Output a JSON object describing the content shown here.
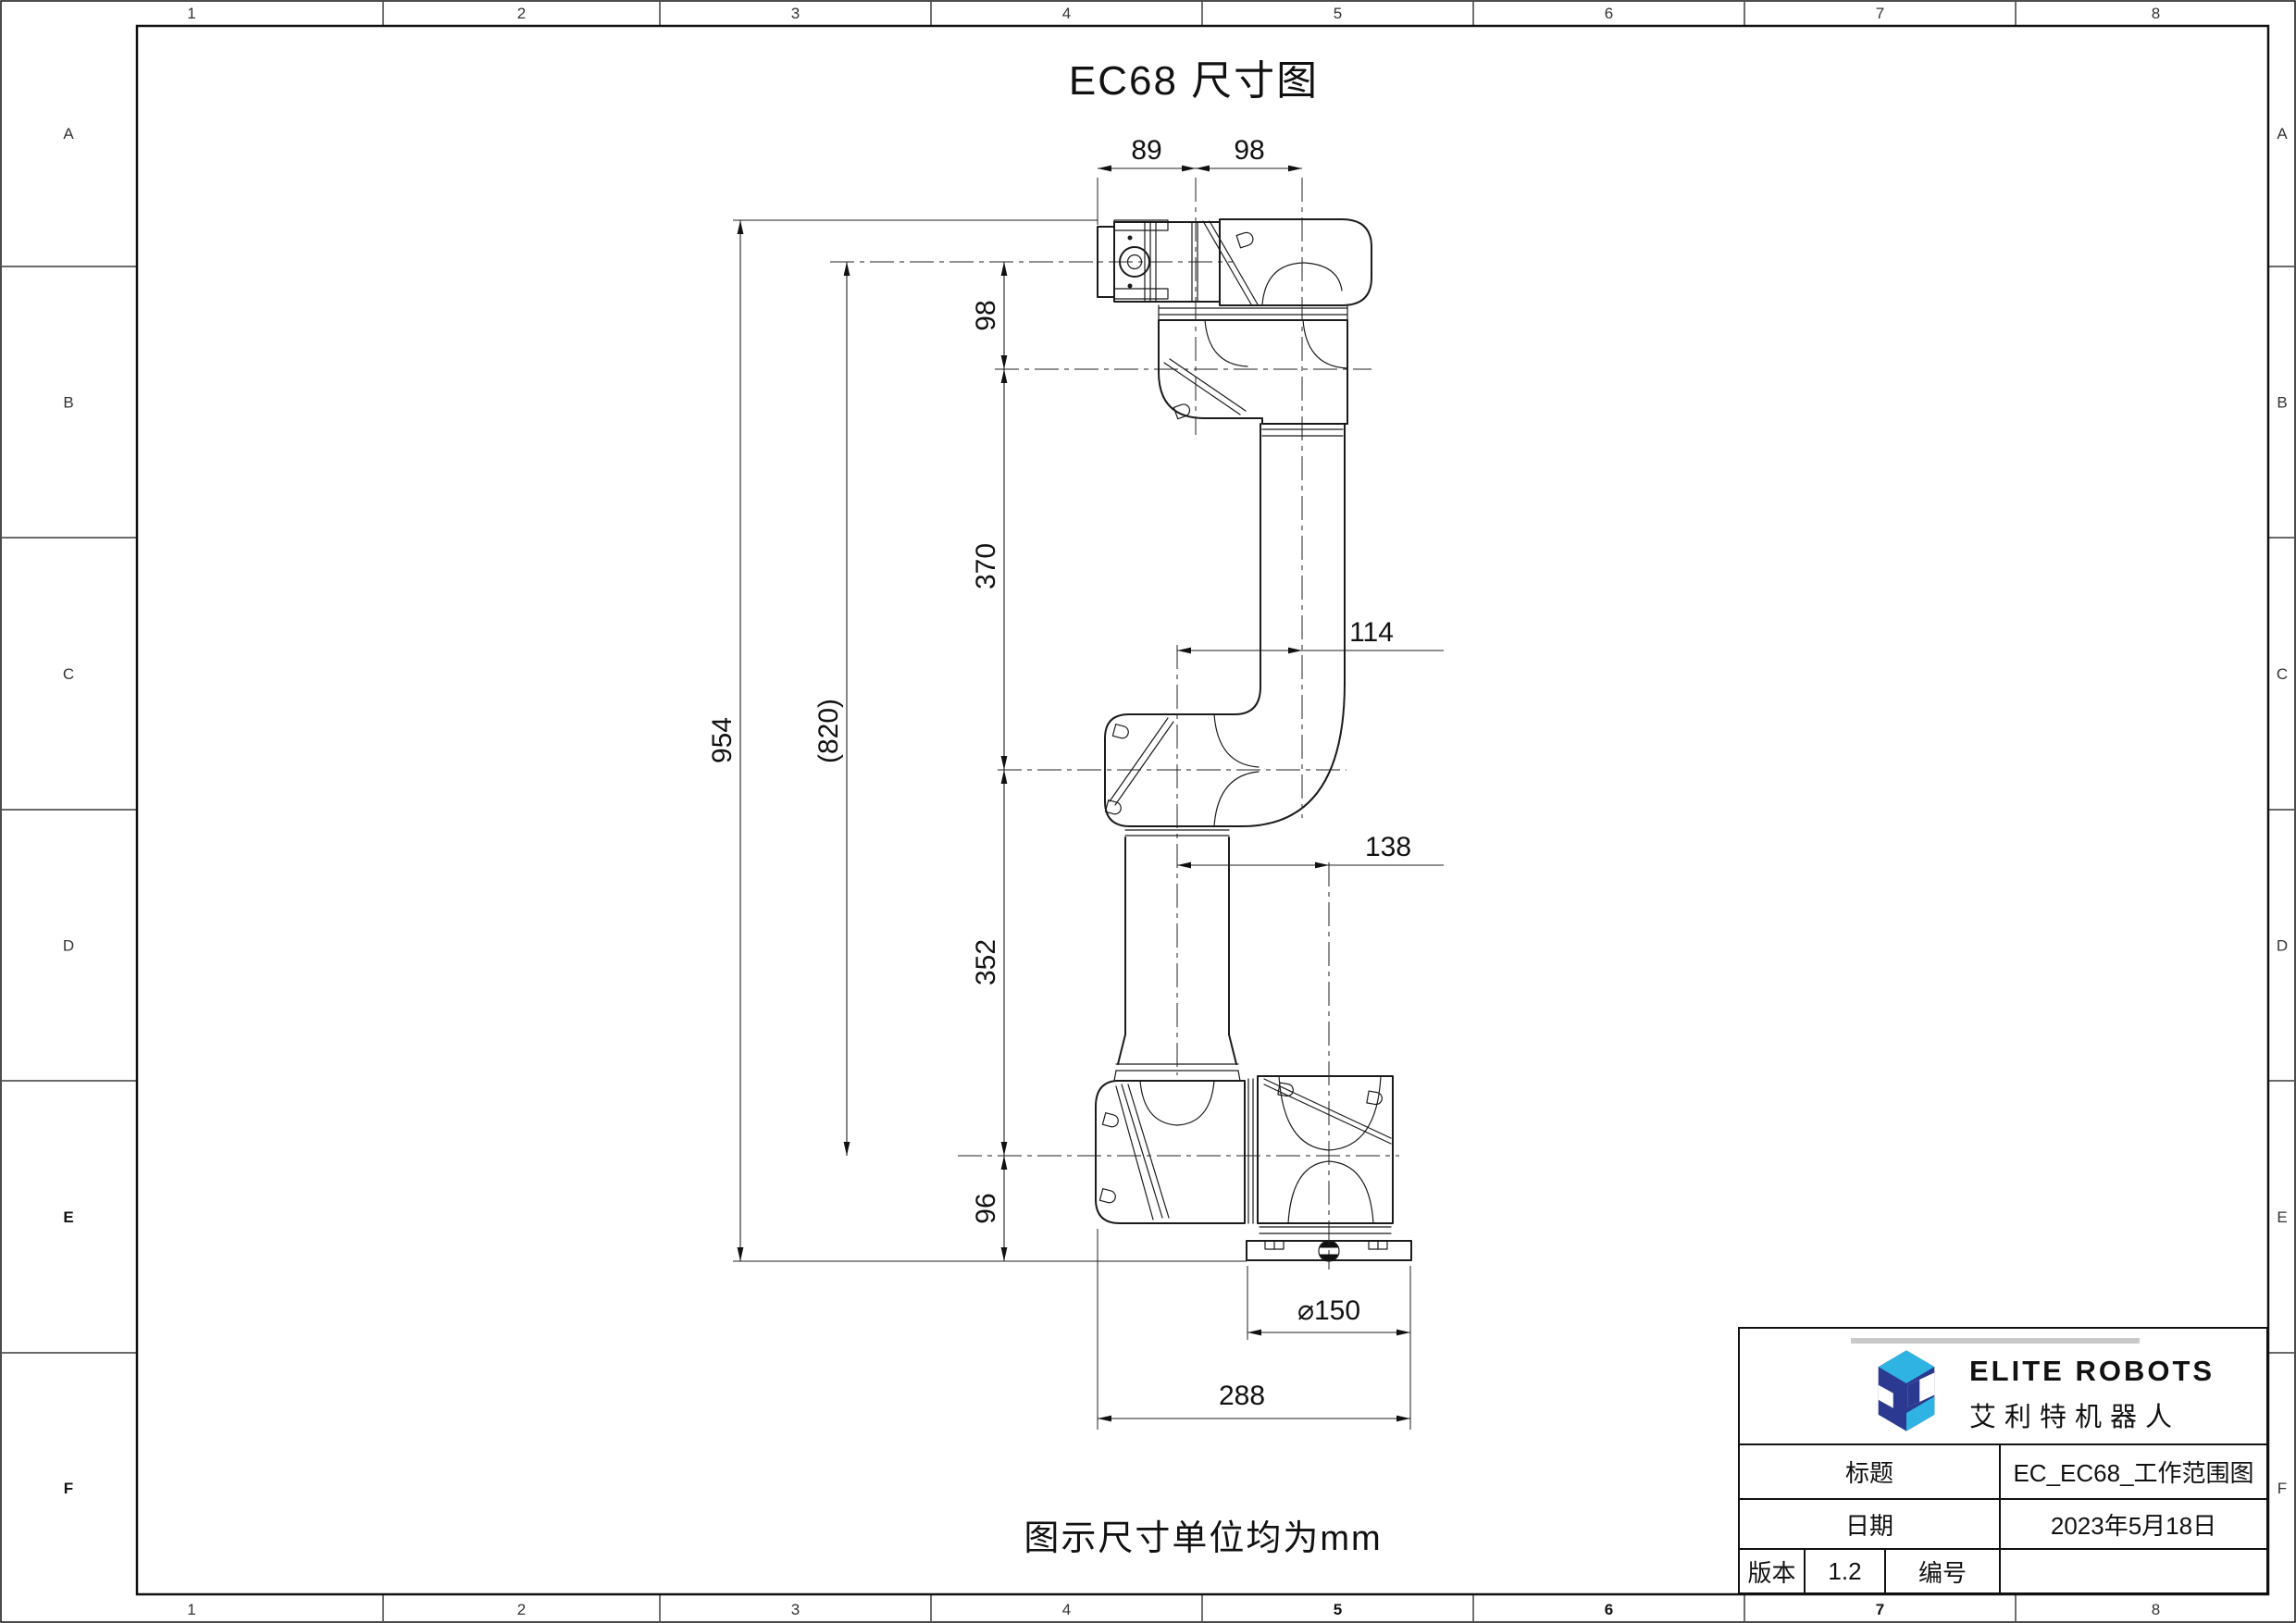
{
  "sheet": {
    "columns": [
      "1",
      "2",
      "3",
      "4",
      "5",
      "6",
      "7",
      "8"
    ],
    "rows": [
      "A",
      "B",
      "C",
      "D",
      "E",
      "F"
    ],
    "bold_bottom_columns": [
      "5",
      "6",
      "7"
    ],
    "bold_left_rows": [
      "E",
      "F"
    ]
  },
  "drawing": {
    "title": "EC68 尺寸图",
    "note": "图示尺寸单位均为mm",
    "dims": {
      "top_89": "89",
      "top_98": "98",
      "side_98": "98",
      "side_370": "370",
      "side_954": "954",
      "side_820": "(820)",
      "side_352": "352",
      "side_96": "96",
      "offset_114": "114",
      "offset_138": "138",
      "base_dia_150": "⌀150",
      "base_width_288": "288"
    }
  },
  "title_block": {
    "brand_en": "ELITE ROBOTS",
    "brand_zh": "艾利特机器人",
    "title_label": "标题",
    "title_value": "EC_EC68_工作范围图",
    "date_label": "日期",
    "date_value": "2023年5月18日",
    "version_label": "版本",
    "version_value": "1.2",
    "number_label": "编号",
    "number_value": ""
  },
  "colors": {
    "logo_navy": "#2b3990",
    "logo_light_blue": "#2fb3e3",
    "line_color": "#1b1b1b"
  }
}
